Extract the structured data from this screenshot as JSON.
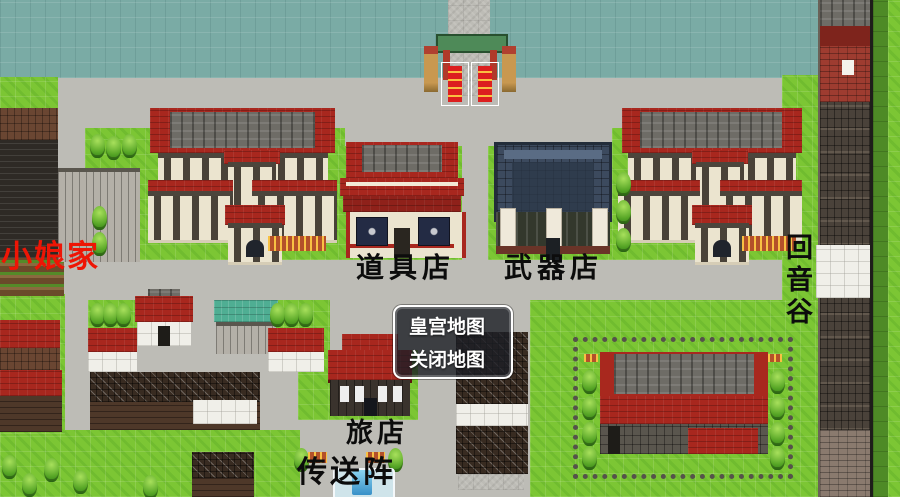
{
  "map_labels": {
    "home": "小娘家",
    "item_shop": "道具店",
    "weapon_shop": "武器店",
    "echo_valley": "回音谷",
    "inn": "旅店",
    "teleport_array": "传送阵"
  },
  "menu": {
    "items": [
      {
        "label": "皇宫地图"
      },
      {
        "label": "关闭地图"
      }
    ]
  },
  "colors": {
    "water": "#7aaba5",
    "grass": "#7cc634",
    "path": "#bdbcb6",
    "roof_red": "#a8271e",
    "roof_slate": "#3c4a5e",
    "wall_cream": "#ebe4cf",
    "label_black": "#0c0c0c",
    "label_red": "#ee1505",
    "menu_background": "rgba(28,30,38,0.80)",
    "menu_border": "#ffffff"
  }
}
